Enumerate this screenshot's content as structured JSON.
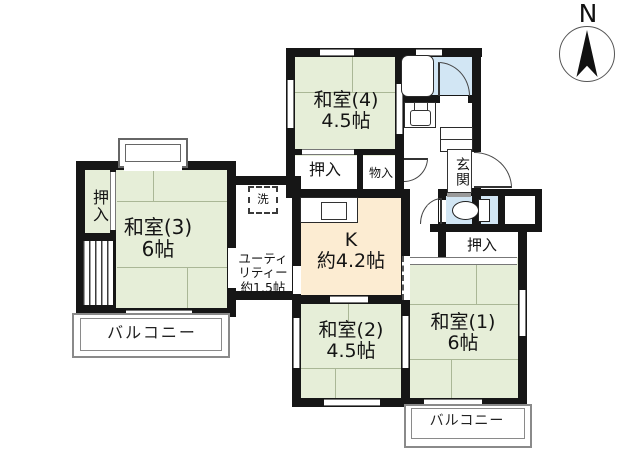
{
  "title": "apartment-floor-plan",
  "compass": {
    "label": "N"
  },
  "palette": {
    "wall": "#161616",
    "tatami": "#e6eed8",
    "kitchen": "#fcecd2",
    "water": "#d2e6f4",
    "rail": "#8a8a8a"
  },
  "rooms": {
    "washitsu4": {
      "name": "和室(4)",
      "size": "4.5帖"
    },
    "washitsu3": {
      "name": "和室(3)",
      "size": "6帖"
    },
    "washitsu2": {
      "name": "和室(2)",
      "size": "4.5帖"
    },
    "washitsu1": {
      "name": "和室(1)",
      "size": "6帖"
    },
    "kitchen": {
      "name": "K",
      "size": "約4.2帖"
    },
    "utility": {
      "line1": "ユーティ",
      "line2": "リティー",
      "line3": "約1.5帖"
    },
    "genkan": {
      "label": "玄関"
    },
    "laundry": {
      "label": "洗"
    }
  },
  "closets": {
    "oshiire_top": {
      "label": "押入"
    },
    "monoire": {
      "label": "物入"
    },
    "oshiire_left": {
      "label": "押入"
    },
    "oshiire_right": {
      "label": "押入"
    }
  },
  "balconies": {
    "left": {
      "label": "バルコニー"
    },
    "right": {
      "label": "バルコニー"
    }
  },
  "icons": [
    "compass-north-icon",
    "bathtub-icon",
    "toilet-icon",
    "washbasin-icon",
    "kitchen-sink-icon",
    "washer-space-icon"
  ]
}
